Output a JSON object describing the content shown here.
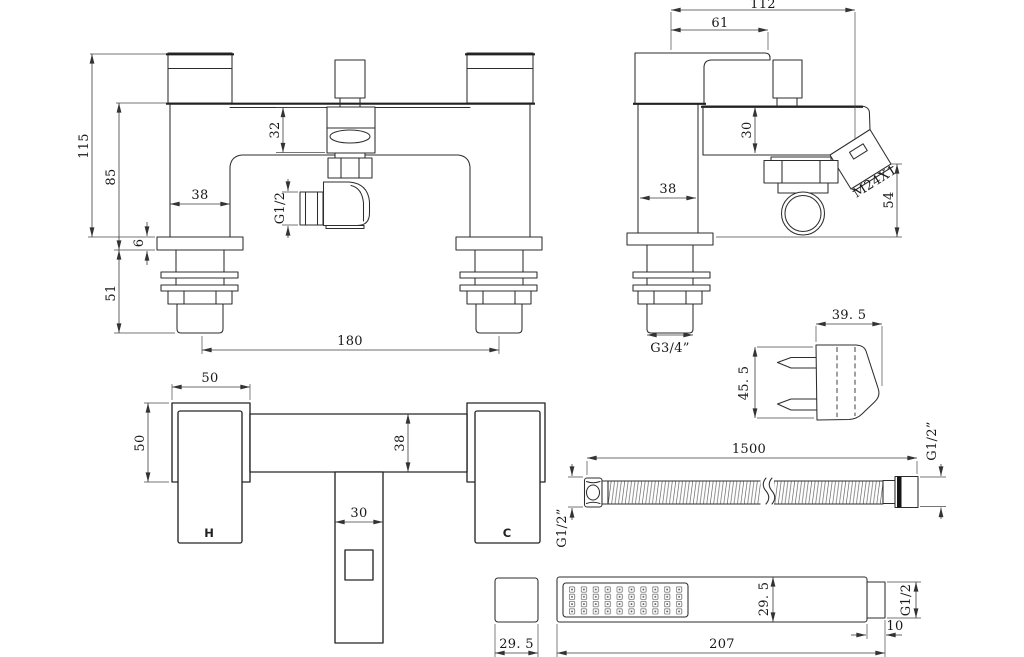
{
  "title": "Bath shower mixer technical drawing",
  "labels": {
    "front": {
      "total_height": "115",
      "body_height": "85",
      "deck_thickness": "6",
      "tail_length": "51",
      "pillar_width": "38",
      "cartridge_height": "32",
      "outlet_thread": "G1/2",
      "pillar_centres": "180"
    },
    "side": {
      "total_depth": "112",
      "handle_depth": "61",
      "body_height": "30",
      "pillar_depth": "38",
      "outlet_thread": "M24X1",
      "outlet_height": "54",
      "inlet_thread": "G3/4”"
    },
    "bracket": {
      "width": "39. 5",
      "height": "45. 5"
    },
    "plan": {
      "handle_width": "50",
      "handle_depth": "50",
      "body_depth": "38",
      "spout_width": "30",
      "hot": "H",
      "cold": "C"
    },
    "hose": {
      "length": "1500",
      "left_thread": "G1/2”",
      "right_thread": "G1/2”"
    },
    "handset": {
      "face_width": "29. 5",
      "length": "207",
      "body_height": "29. 5",
      "thread": "G1/2",
      "neck_length": "10"
    }
  }
}
